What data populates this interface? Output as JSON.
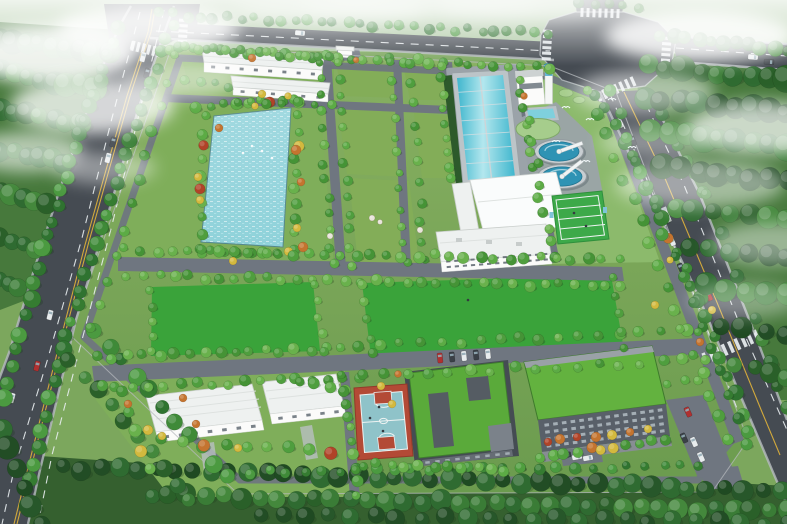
{
  "scene": {
    "title": "Aerial bird's-eye rendering of a landscaped water-treatment plant campus on a hazy day",
    "view": "elevated perspective looking across a walled rectangular site bounded by tree-lined arterial roads, with low clouds drifting over surrounding forest"
  },
  "palette": {
    "ground_base": "#7ca75d",
    "distant_green": "#aec9a4",
    "forest_base": "#47793c",
    "forest_dark2": "#35602f",
    "tree_bright": "#5cab45",
    "road_major": "#454b52",
    "road_minor": "#6f7680",
    "lane_white": "#e9eef1",
    "lane_yellow": "#d2a93c",
    "sidewalk": "#b6bcc0",
    "lawn_bright": "#3aa33a",
    "plot_green": "#83ad58",
    "lawn_soft": "#7fae5a",
    "lawn_soft2": "#8cba6c",
    "pond_blue": "#8fd2da",
    "basin_cyan": "#3fb6cd",
    "basin_light": "#b3e7ee",
    "clarifier_blue": "#2f93b4",
    "tank_rim": "#c8ced2",
    "pool_blue": "#7fd0dd",
    "circle_green": "#a6cd8c",
    "roof_white": "#eef1f0",
    "roof_bright": "#fafcfc",
    "wall_white": "#fbfbfa",
    "roof_green": "#5aaa3a",
    "roof_green2": "#63b23f",
    "facade_dark": "#596069",
    "window_light": "#a9b2b9",
    "window_dark": "#5a646d",
    "court_red": "#b34a36",
    "court_teal": "#8fc3c9",
    "court_green": "#3da949",
    "autumn_orange": "#c4742f",
    "autumn_yellow": "#d3b93e",
    "autumn_red": "#b04328",
    "car_white": "#e8ecee",
    "car_dark": "#3a4046",
    "car_red": "#b03030",
    "mist": "#ffffff",
    "water_tower_blue": "#3f9fc4",
    "pavement": "#9ba3a9"
  },
  "inventory": {
    "water_features": [
      "landscape pond with waterfowl",
      "long two-lane treatment basin",
      "2 circular clarifier tanks with scraper bridges",
      "small blue tank beside pump house"
    ],
    "buildings": [
      "north dormitory block",
      "north annex block",
      "entrance gatehouse",
      "pump house with blue-capped tower",
      "main process building with bright white roof",
      "two-storey plant building with window band",
      "southwest office block A",
      "southwest office block B",
      "courtyard building with planted green roof",
      "large office building with planted green roof and dark window facade"
    ],
    "recreation": [
      "basketball court with red border and teal surface",
      "green sports court with white markings"
    ],
    "landscape": [
      "2 large reserved lawns",
      "rectangular planting plots",
      "tree-lined internal road grid",
      "perimeter tree belts and boundary wall",
      "autumn accent trees in orange, yellow and red",
      "dense forest with drifting low clouds"
    ],
    "roads": [
      "west arterial road with double yellow centerline",
      "north connector road",
      "east arterial road",
      "large crossroads intersection with zebra crossings",
      "pedestrian zebra crossing on east road"
    ],
    "vehicles": [
      "cars travelling on arterial roads",
      "white truck on east road",
      "row of parked cars at courtyard building",
      "parking lot cars beside office building"
    ],
    "wildlife": [
      "white birds flying over forest",
      "white waterfowl on the pond"
    ]
  }
}
